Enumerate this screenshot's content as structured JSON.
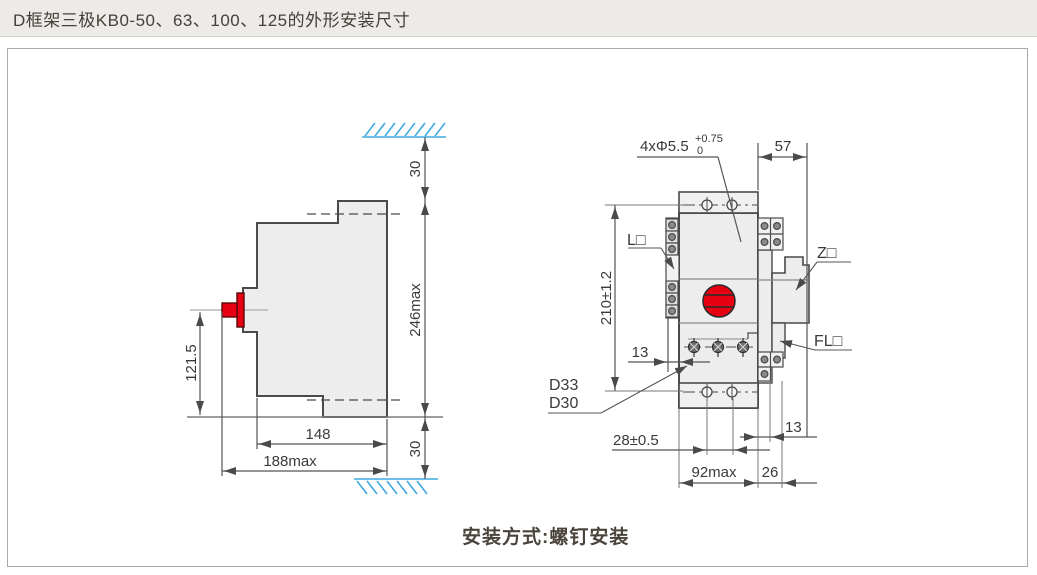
{
  "header": {
    "title": "D框架三极KB0-50、63、100、125的外形安装尺寸"
  },
  "footer": {
    "caption": "安装方式:螺钉安装"
  },
  "side_view": {
    "dim_top_clearance": "30",
    "dim_height": "246max",
    "dim_bottom_clearance": "30",
    "dim_handle_center": "121.5",
    "dim_depth": "148",
    "dim_depth_max": "188max"
  },
  "front_view": {
    "dim_holes": "4xΦ5.5",
    "dim_holes_tol_plus": "+0.75",
    "dim_holes_tol_base": "0",
    "dim_top_width": "57",
    "dim_hole_pitch_vertical": "210±1.2",
    "dim_pole_offset": "13",
    "dim_hole_pitch_horizontal": "28±0.5",
    "dim_width_max": "92max",
    "dim_right_width": "26",
    "dim_right_strip": "13",
    "label_l": "L□",
    "label_z": "Z□",
    "label_fl": "FL□",
    "label_d33": "D33",
    "label_d30": "D30"
  },
  "colors": {
    "accent_red": "#e60012",
    "hatch_blue": "#3fa9e0",
    "line": "#4a4a4a"
  }
}
